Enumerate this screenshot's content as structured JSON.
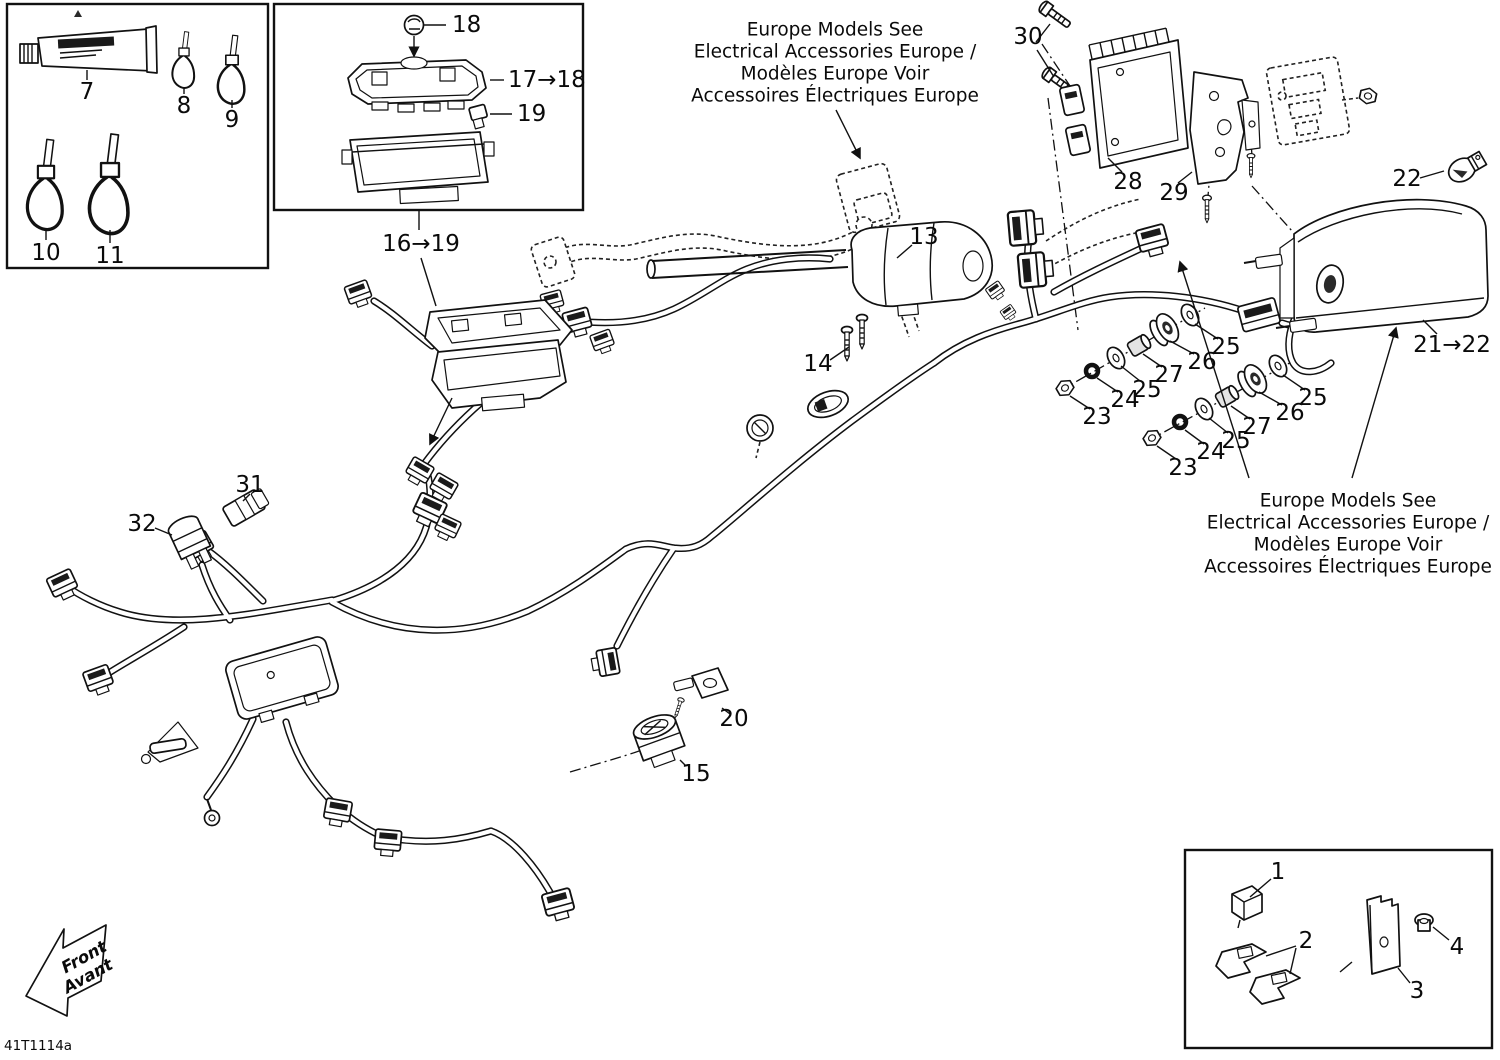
{
  "diagram": {
    "code": "41T1114a",
    "direction_arrow": {
      "line1": "Front",
      "line2": "Avant"
    },
    "notes": {
      "europe_top": [
        "Europe Models See",
        "Electrical Accessories Europe /",
        "Modèles Europe Voir",
        "Accessoires Électriques Europe"
      ],
      "europe_right": [
        "Europe Models See",
        "Electrical Accessories Europe /",
        "Modèles Europe Voir",
        "Accessoires Électriques Europe"
      ]
    },
    "labels": {
      "1": "1",
      "2": "2",
      "3": "3",
      "4": "4",
      "7": "7",
      "8": "8",
      "9": "9",
      "10": "10",
      "11": "11",
      "13": "13",
      "14": "14",
      "15": "15",
      "18": "18",
      "19": "19",
      "20": "20",
      "22": "22",
      "23": "23",
      "24": "24",
      "25": "25",
      "26": "26",
      "27": "27",
      "28": "28",
      "29": "29",
      "30": "30",
      "31": "31",
      "32": "32",
      "range_17_18": "17→18",
      "range_16_19": "16→19",
      "range_21_22": "21→22"
    }
  }
}
